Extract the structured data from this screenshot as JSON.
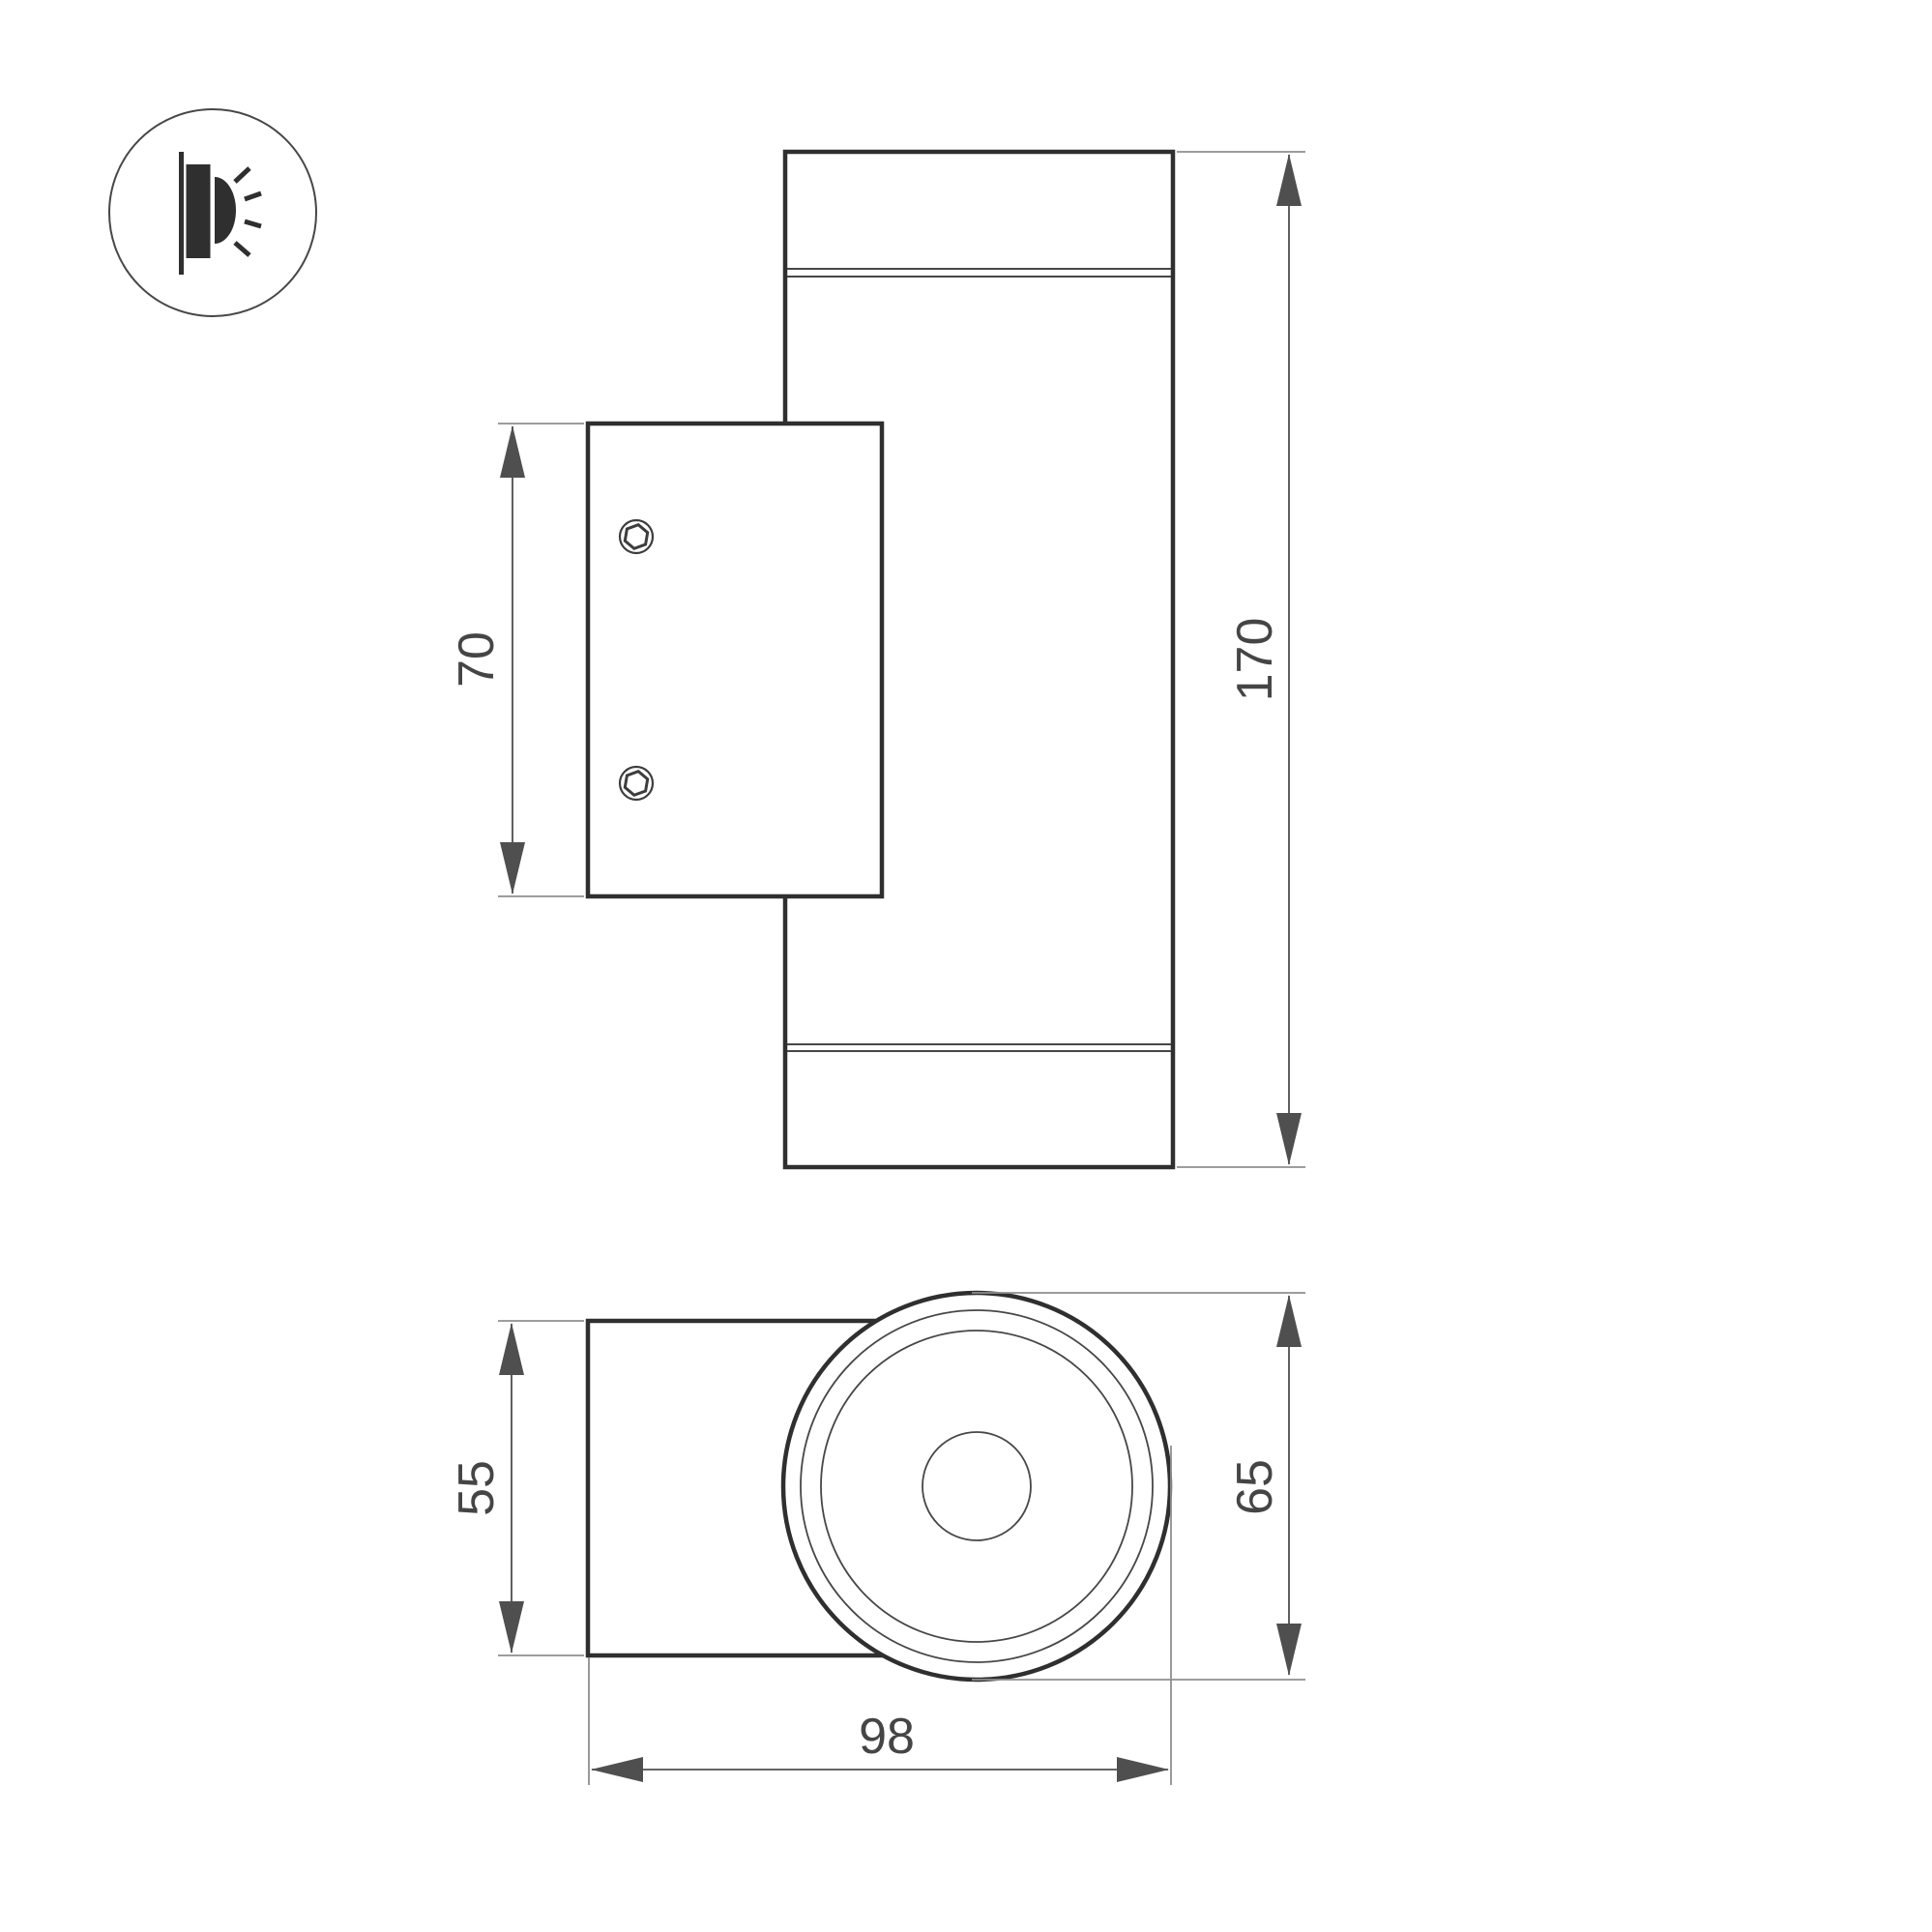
{
  "icon": {
    "name": "wall-light-emission-icon",
    "description_parts": [
      "wall-line",
      "lamp-body",
      "light-half-disc",
      "light-rays"
    ]
  },
  "views": {
    "side": {
      "name": "side-elevation-view",
      "dimensions": {
        "bracket_height": "70",
        "total_height": "170"
      }
    },
    "top": {
      "name": "top-plan-view",
      "dimensions": {
        "mount_width": "55",
        "body_diameter": "65",
        "total_depth": "98"
      }
    }
  },
  "colors": {
    "background": "#ffffff",
    "ink": "#2f2f2f",
    "thin_line": "#474747",
    "ext_line": "#8f8f8f",
    "dim_line": "#4f4f4f",
    "screw": "#3d3d3d",
    "label": "#454545"
  }
}
